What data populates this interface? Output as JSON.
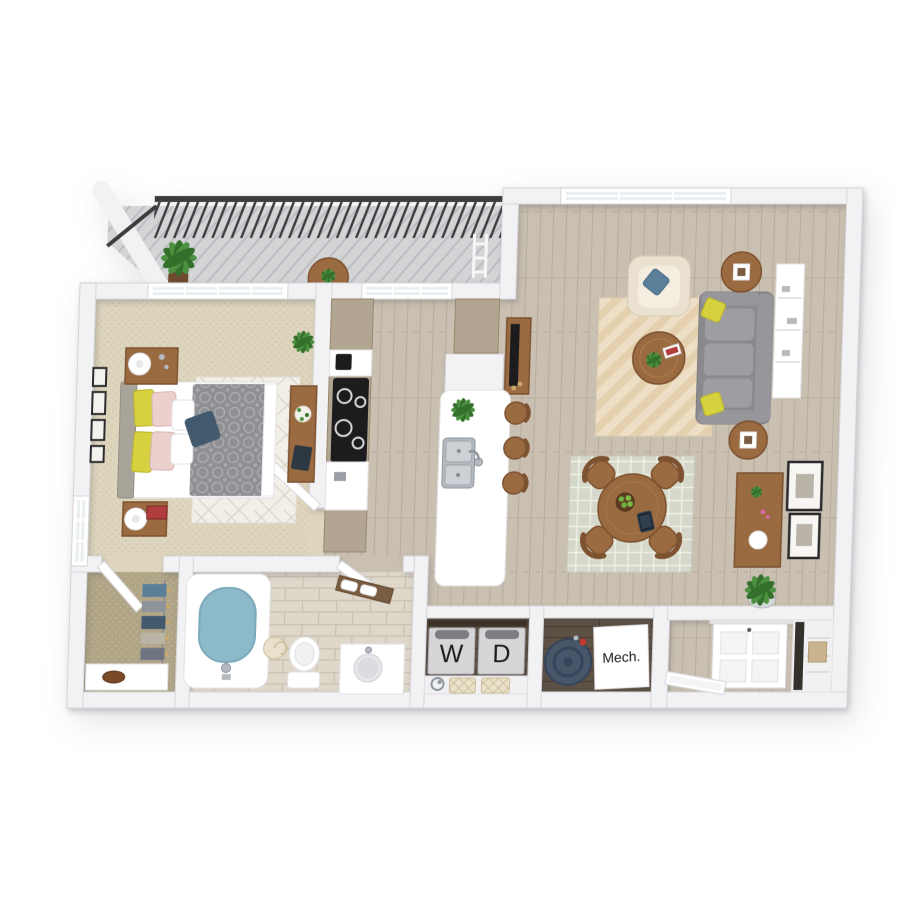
{
  "image": {
    "kind": "3d-apartment-floor-plan-rendering",
    "background": "#ffffff"
  },
  "floorplan": {
    "labels": {
      "washer": "W",
      "dryer": "D",
      "mechanical": "Mech."
    },
    "rooms": [
      "balcony",
      "bedroom",
      "walk-in-closet",
      "bathroom",
      "kitchen",
      "living-room",
      "dining-area",
      "laundry-closet",
      "mechanical-closet",
      "entry"
    ],
    "furniture": [
      "queen-bed",
      "nightstands",
      "table-lamps",
      "desk-with-laptop",
      "wall-art",
      "kitchen-cabinets",
      "cooktop",
      "island-with-double-sink",
      "barstools",
      "tv-console",
      "sofa",
      "armchair",
      "coffee-table",
      "end-tables-with-lanterns",
      "wall-shelf",
      "dining-table-with-four-chairs",
      "fruit-bowl",
      "tablet",
      "sideboard",
      "bathtub",
      "toilet",
      "vanity-sink",
      "towel-shelf",
      "washer",
      "dryer",
      "water-heater",
      "front-door",
      "coat-closet",
      "balcony-railing",
      "patio-table",
      "drying-rack",
      "potted-plants",
      "area-rugs"
    ],
    "colors": {
      "wall": "#f2f2f4",
      "wallEdge": "#d6d6da",
      "floorWood": "#c9c0b1",
      "floorWoodLine": "#b7ad9e",
      "carpet": "#ddd5bd",
      "carpetDot": "#cdc3a3",
      "closetFloor": "#b0a487",
      "tile": "#ded7ca",
      "grout": "#c8c0b0",
      "floorDark": "#5d5044",
      "floorDarkLine": "#463b30",
      "deck": "#d3d4d6",
      "deckLine": "#bcbdc0",
      "railing": "#3d3d40",
      "cabinet": "#b2a591",
      "cabinetEdge": "#97896f",
      "wood": "#9a6a41",
      "woodDark": "#7d5230",
      "sofa": "#9e9ea2",
      "sofaDark": "#8a8a8e",
      "cream": "#eae1d0",
      "creamLight": "#f4ede0",
      "yellow": "#d6d13e",
      "navy": "#42596e",
      "blue": "#5b7f99",
      "pink": "#ecd0cd",
      "duvet": "#8f9094",
      "duvetLine": "#abacb0",
      "rugBed": "#f2eee8",
      "rugBedLine": "#d8cfc5",
      "rugLiving": "#eddfc5",
      "rugLivingLine": "#dcc197",
      "rugDining": "#d5d8ca",
      "rugDiningLine": "#eef0e5",
      "plant": "#4c9140",
      "plantDark": "#34702c",
      "water": "#8dbac9",
      "waterEdge": "#7aa9ba",
      "steel": "#b4bac0",
      "steelDark": "#8e969d",
      "machine": "#d6d6d9",
      "machineEdge": "#aaaaaf",
      "machineTop": "#7d7d82",
      "heater": "#475669",
      "heaterDark": "#36455a",
      "black": "#1c1c1e",
      "label": "#1d1d1f",
      "frame": "#2b2b2d",
      "basket": "#e9e1cb",
      "basketLine": "#cfc09a",
      "white": "#ffffff",
      "doorEdge": "#d8d8dc",
      "shelfWood": "#7a5c42",
      "red": "#b13c3c"
    }
  }
}
